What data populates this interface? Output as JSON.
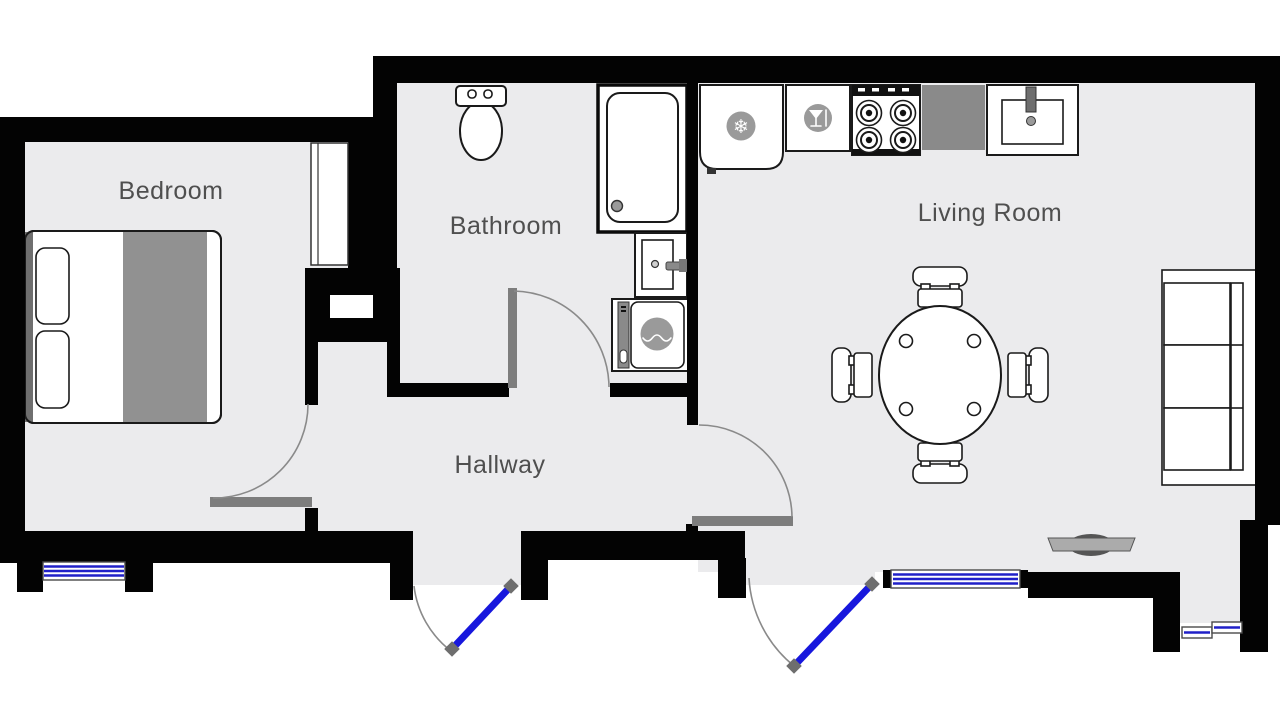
{
  "floorplan": {
    "type": "apartment-floor-plan",
    "rooms": [
      {
        "id": "bedroom",
        "label": "Bedroom"
      },
      {
        "id": "bathroom",
        "label": "Bathroom"
      },
      {
        "id": "hallway",
        "label": "Hallway"
      },
      {
        "id": "living-room",
        "label": "Living Room"
      }
    ],
    "fixtures": [
      "double-bed",
      "wardrobe-closet",
      "toilet",
      "shower",
      "bathroom-sink",
      "washing-machine",
      "fridge",
      "dishwasher",
      "stove",
      "kitchen-counter",
      "kitchen-sink",
      "dining-table",
      "dining-chair",
      "sofa",
      "tv",
      "interior-door-arc",
      "entry-door",
      "balcony-door",
      "window"
    ],
    "colors": {
      "wall": "#030303",
      "floor": "#ebebed",
      "door_blue": "#1717dd",
      "window_blue": "#2020c8",
      "threshold_gray": "#7d7d7d",
      "furniture_gray": "#8f8f8f",
      "icon_gray": "#9a9a9a",
      "arc_gray": "#8a8a8a",
      "label_gray": "#4f4f4f",
      "line": "#1a1a1a"
    }
  }
}
